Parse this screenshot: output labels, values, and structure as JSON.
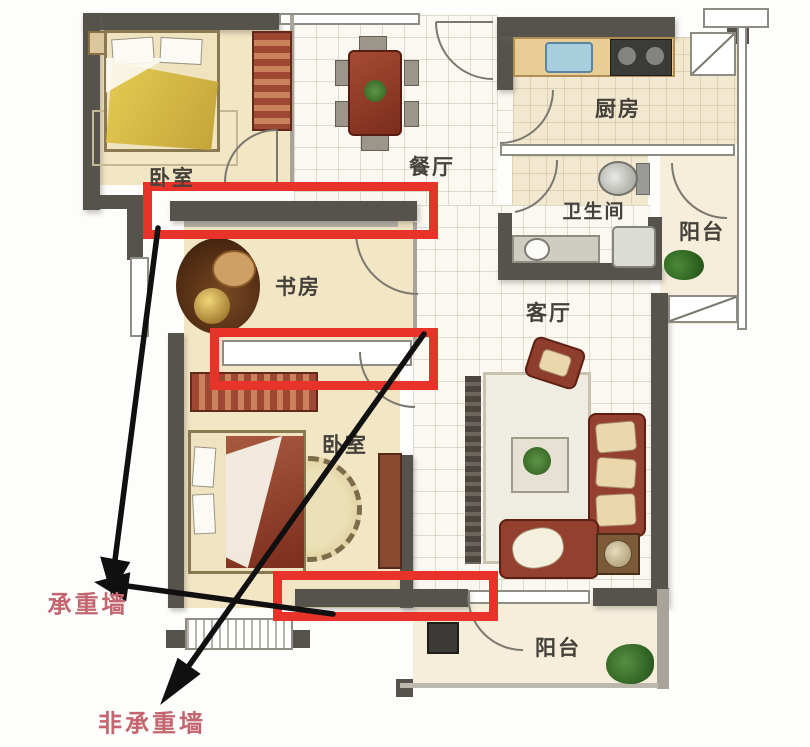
{
  "type": "annotated-floor-plan",
  "rooms": [
    {
      "id": "bedroom-top",
      "label": "卧室"
    },
    {
      "id": "dining",
      "label": "餐厅"
    },
    {
      "id": "kitchen",
      "label": "厨房"
    },
    {
      "id": "bathroom",
      "label": "卫生间"
    },
    {
      "id": "balcony-right",
      "label": "阳台"
    },
    {
      "id": "study",
      "label": "书房"
    },
    {
      "id": "living",
      "label": "客厅"
    },
    {
      "id": "bedroom-bottom",
      "label": "卧室"
    },
    {
      "id": "balcony-bottom",
      "label": "阳台"
    }
  ],
  "annotations": {
    "load_bearing_label": "承重墙",
    "non_load_bearing_label": "非承重墙",
    "highlighted_wall_count": 3,
    "arrow_count": 3,
    "highlight_color": "#e8332a",
    "label_color": "#c4666f",
    "arrow_color": "#101010"
  },
  "colors": {
    "wall": "#55534c",
    "floor": "#f3e6c4",
    "tile": "#faf8f1",
    "furniture_wood": "#93402e"
  }
}
